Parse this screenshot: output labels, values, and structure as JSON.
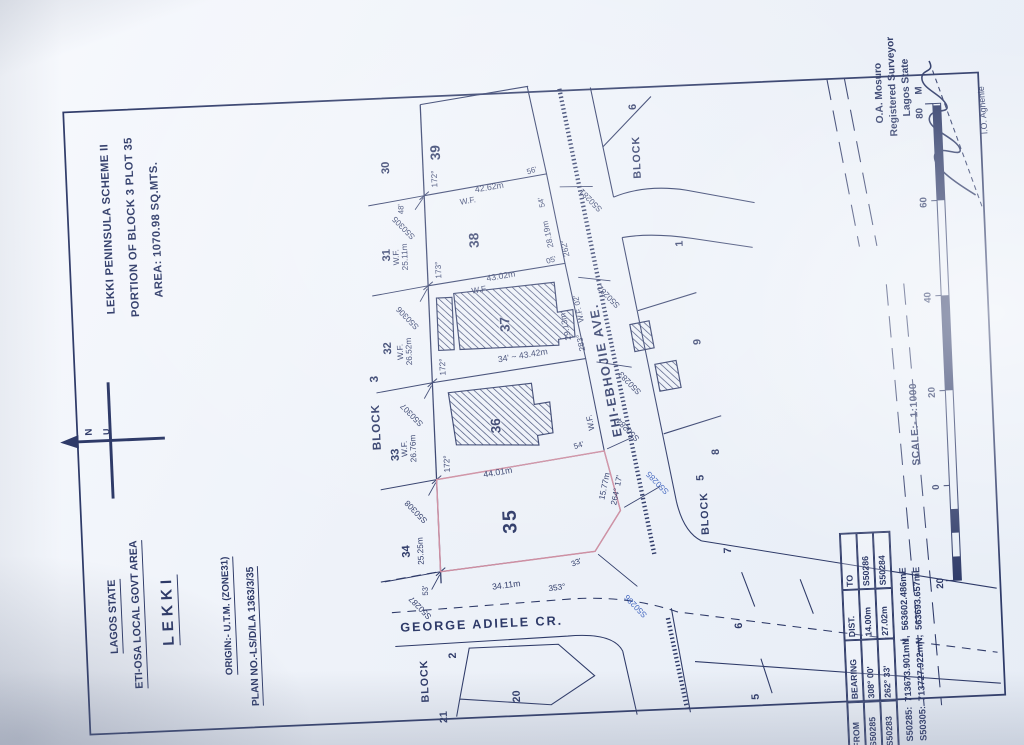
{
  "header": {
    "state": "LAGOS STATE",
    "lga": "ETI-OSA LOCAL GOVT AREA",
    "town": "LEKKI",
    "origin": "ORIGIN:- U.T.M. (ZONE31)",
    "plan_no": "PLAN NO.-LS/D/LA 1363/3/35"
  },
  "title": {
    "line1": "LEKKI PENINSULA SCHEME II",
    "line2": "PORTION OF BLOCK 3 PLOT 35",
    "line3": "AREA: 1070.98 SQ.MTS."
  },
  "north": {
    "n": "N",
    "u": "U"
  },
  "streets": {
    "george": "GEORGE ADIELE CR.",
    "ehi": "EHI-EBHOJIE AVE."
  },
  "block_word": "BLOCK",
  "block_nums": {
    "b2": "2",
    "b3": "3",
    "b5": "5",
    "b6": "6"
  },
  "plots": {
    "p1": "1",
    "p2": "2",
    "p5": "5",
    "p6": "6",
    "p7": "7",
    "p8": "8",
    "p9": "9",
    "p20": "20",
    "p21": "21",
    "p30": "30",
    "p31": "31",
    "p32": "32",
    "p33": "33",
    "p34": "34",
    "p35": "35",
    "p36": "36",
    "p37": "37",
    "p38": "38",
    "p39": "39"
  },
  "beacons": {
    "s50281": "S50281",
    "s50282": "S50282",
    "s50283": "S50283",
    "s50284": "S50284",
    "s50285": "S50285",
    "s50286": "S50286",
    "s50287": "S50287",
    "s50305": "S50305",
    "s50306": "S50306",
    "s50307": "S50307",
    "s50308": "S50308"
  },
  "dims": {
    "wf": "W.F.",
    "d2676": "26.76m",
    "d2652": "26.52m",
    "d2511": "25.11m",
    "d2525": "25.25m",
    "d4262": "42.62m",
    "d4302": "43.02m",
    "d4342": "34' ~ 43.42m",
    "d4401": "44.01m",
    "d3411": "34.11m",
    "d1577": "15.77m",
    "d2819": "28.19m",
    "d2913": "29.13m"
  },
  "angles": {
    "a172": "172°",
    "a173": "173°",
    "a353": "353°",
    "a262": "262°",
    "a283": "283°",
    "a26417": "264° 17'",
    "m56": "56'",
    "m05": "05'",
    "m54": "54'",
    "m53": "53'",
    "m48": "48'",
    "m33": "33'",
    "wf02": "W.F. 02'"
  },
  "table": {
    "headers": [
      "FROM",
      "BEARING",
      "DIST.",
      "TO"
    ],
    "rows": [
      [
        "S50285",
        "308° 00'",
        "14.00m",
        "S50286"
      ],
      [
        "S50283",
        "262° 33'",
        "27.02m",
        "S50284"
      ]
    ]
  },
  "coordinates": {
    "line1": "S50285:  713673.901mN,  563602.486mE",
    "line2": "S50305:  713727.922mN,  563693.657mE"
  },
  "scale_bar": {
    "labels": [
      "20",
      "0",
      "20",
      "40",
      "60",
      "80"
    ],
    "unit": "M",
    "text": "SCALE:- 1:1000"
  },
  "surveyor": {
    "name": "O.A. Mosuro",
    "title": "Registered Surveyor",
    "region": "Lagos State",
    "signee": "I.O. Aghenle"
  },
  "colors": {
    "ink": "#2e3a68",
    "blue_label": "#4468c0",
    "plot_outline": "#cf8fa2",
    "paper": "#f2f5fb"
  }
}
